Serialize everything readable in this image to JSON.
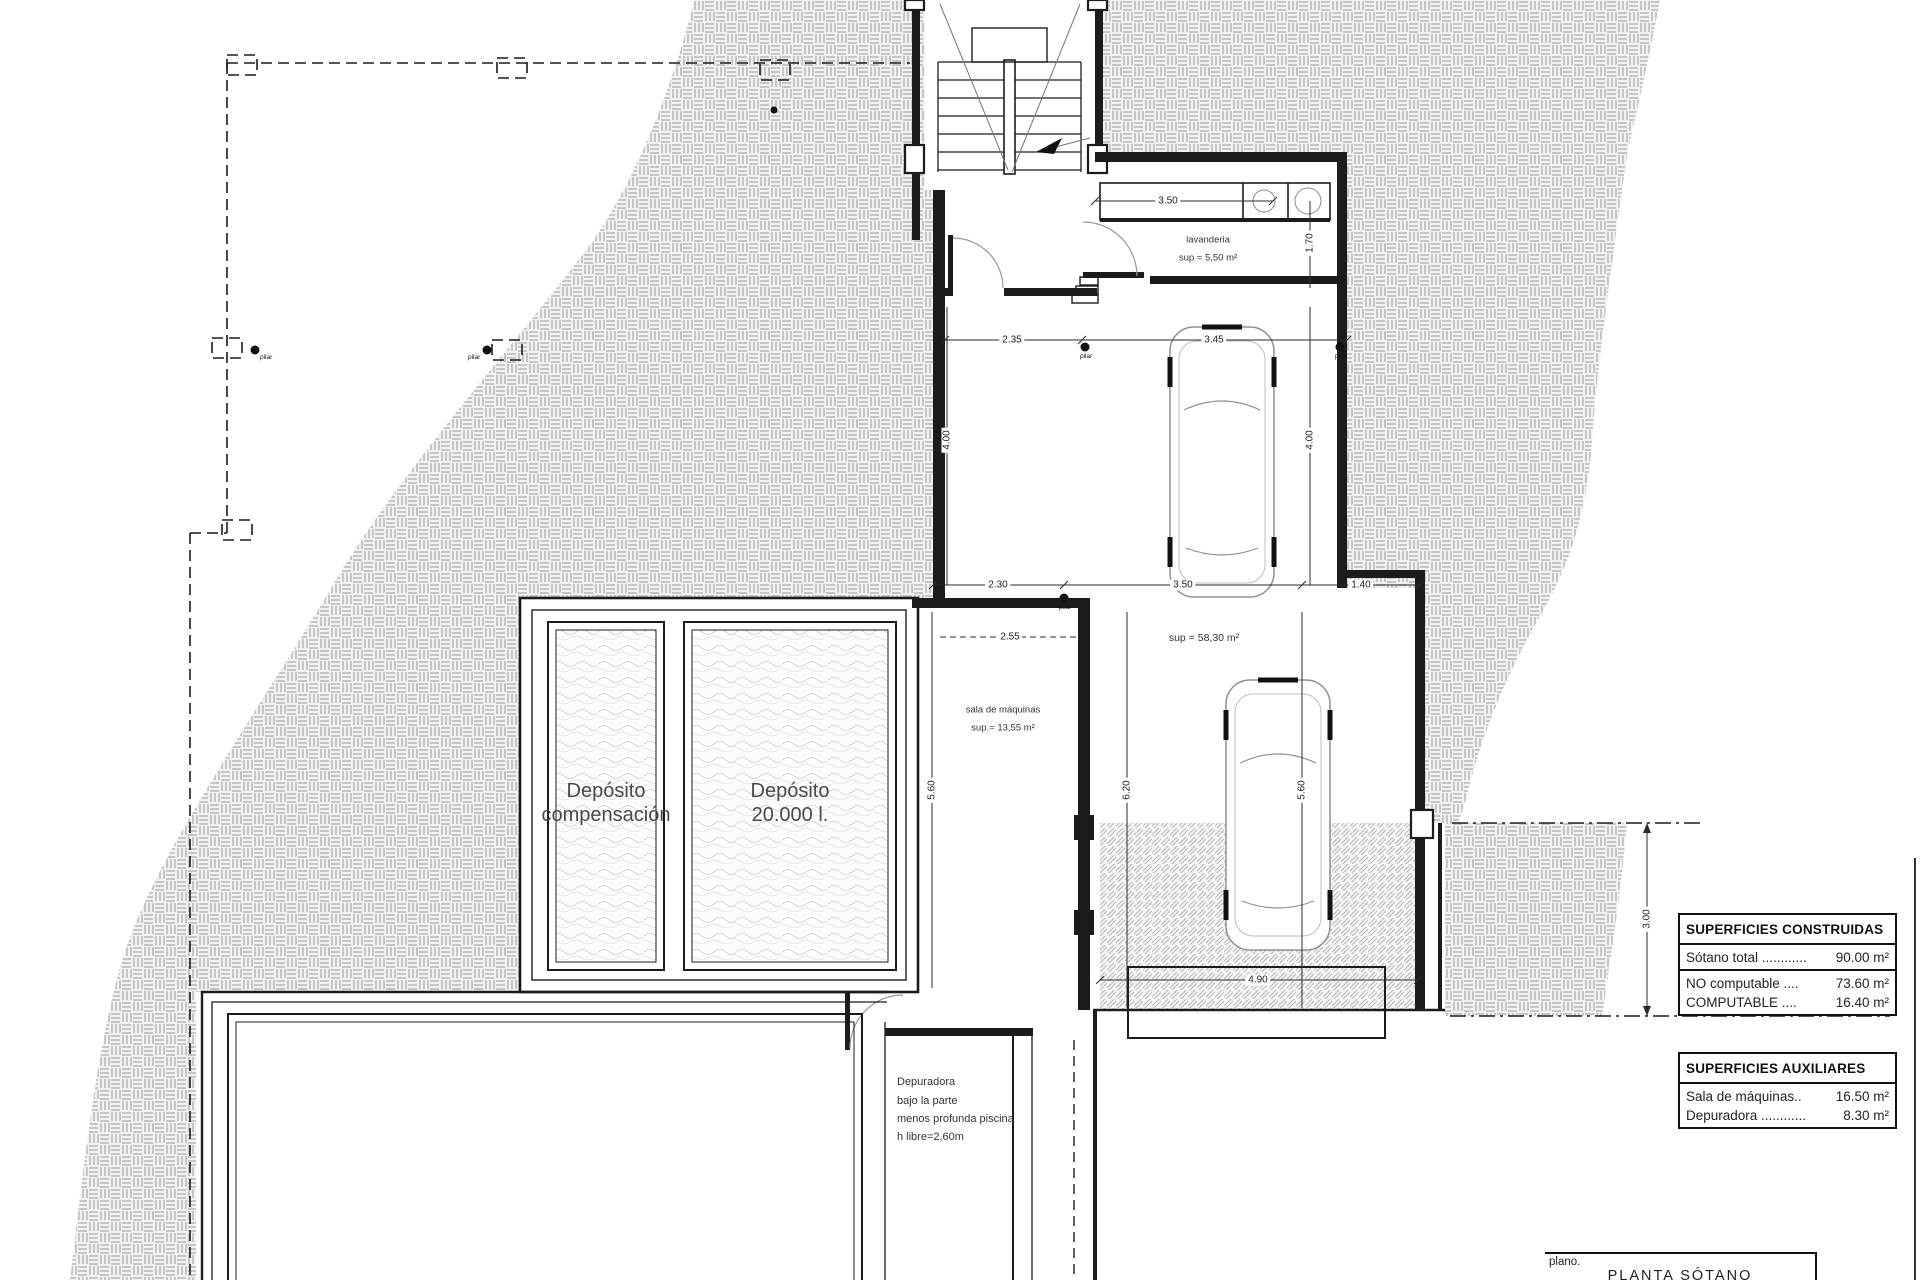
{
  "drawing": {
    "rooms": {
      "laundry": {
        "name": "lavanderia",
        "area": "sup = 5,50 m²"
      },
      "machine_room": {
        "name": "sala de máquinas",
        "area": "sup.= 13,55 m²"
      },
      "garage": {
        "area": "sup = 58,30 m²"
      },
      "tank_compensation": {
        "line1": "Depósito",
        "line2": "compensación"
      },
      "tank_20000": {
        "line1": "Depósito",
        "line2": "20.000 l."
      }
    },
    "notes": {
      "depuradora": {
        "line1": "Depuradora",
        "line2": "bajo la parte",
        "line3": "menos profunda piscina",
        "line4": "h libre=2,60m"
      }
    },
    "dimensions": {
      "laundry_width": "3.50",
      "laundry_depth": "1.70",
      "garage_top_left": "2.35",
      "garage_top_right": "3.45",
      "garage_left_height": "4.00",
      "garage_right_height": "4.00",
      "mid_left": "2.30",
      "mid_center": "3.50",
      "mid_right": "1.40",
      "machine_room_width": "2.55",
      "lower_left_height": "5.60",
      "lower_center_height": "6.20",
      "lower_right_height": "5.60",
      "ramp_width": "4.90",
      "setback_depth": "3.00"
    },
    "markers": {
      "pilar": "pilar"
    }
  },
  "tables": {
    "constructed": {
      "title": "SUPERFICIES CONSTRUIDAS",
      "rows": [
        {
          "label": "Sótano total ............",
          "value": "90.00 m²"
        },
        {
          "label": "NO computable ....",
          "value": "73.60 m²"
        },
        {
          "label": "COMPUTABLE      ....",
          "value": "16.40 m²"
        }
      ]
    },
    "auxiliary": {
      "title": "SUPERFICIES AUXILIARES",
      "rows": [
        {
          "label": "Sala de máquinas..",
          "value": "16.50 m²"
        },
        {
          "label": "Depuradora ............",
          "value": "8.30 m²"
        }
      ]
    }
  },
  "title_block": {
    "plano_label": "plano.",
    "plan_name": "PLANTA  SÓTANO"
  }
}
